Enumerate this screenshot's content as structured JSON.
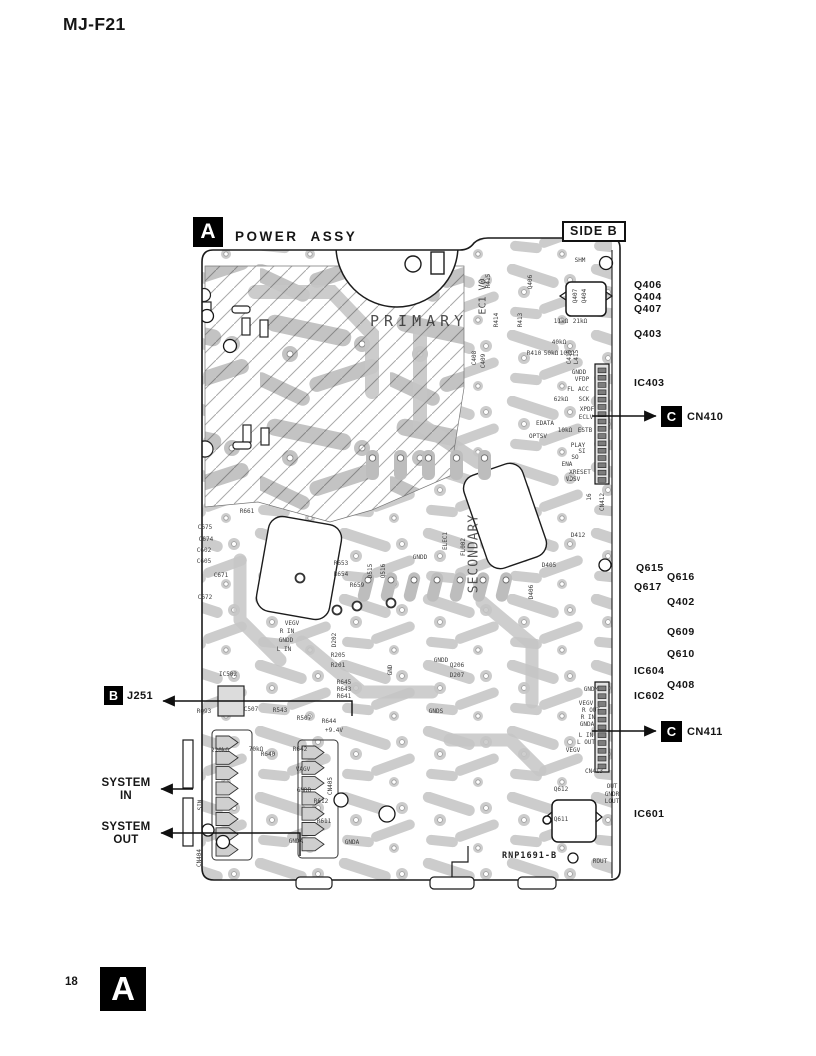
{
  "page": {
    "title": "MJ-F21",
    "page_number": "18",
    "footer_badge": "A"
  },
  "diagram": {
    "badge": "A",
    "badge_b": "B",
    "badge_c": "C",
    "title": "POWER  ASSY",
    "side_label": "SIDE B",
    "board_code": "RNP1691-B",
    "board_text": {
      "primary": "PRIMARY",
      "secondary": "SECONDARY",
      "ec1": "EC1 V0"
    },
    "callouts": {
      "q406": "Q406",
      "q404": "Q404",
      "q407": "Q407",
      "q403": "Q403",
      "ic403": "IC403",
      "cn410": "CN410",
      "q615": "Q615",
      "q616": "Q616",
      "q617": "Q617",
      "q402": "Q402",
      "q609": "Q609",
      "q610": "Q610",
      "ic604": "IC604",
      "q408": "Q408",
      "ic602": "IC602",
      "cn411": "CN411",
      "ic601": "IC601",
      "j251": "J251",
      "system_in_1": "SYSTEM",
      "system_in_2": "IN",
      "system_out_1": "SYSTEM",
      "system_out_2": "OUT"
    },
    "small_labels": [
      {
        "t": "SHM",
        "x": 580,
        "y": 261
      },
      {
        "t": "Q406",
        "x": 531,
        "y": 282,
        "r": -90
      },
      {
        "t": "R415",
        "x": 489,
        "y": 281,
        "r": -90
      },
      {
        "t": "R414",
        "x": 497,
        "y": 320,
        "r": -90
      },
      {
        "t": "R413",
        "x": 521,
        "y": 320,
        "r": -90
      },
      {
        "t": "Q407",
        "x": 576,
        "y": 296,
        "r": -90
      },
      {
        "t": "Q404",
        "x": 585,
        "y": 296,
        "r": -90
      },
      {
        "t": "11kΩ",
        "x": 561,
        "y": 322
      },
      {
        "t": "21kΩ",
        "x": 580,
        "y": 322
      },
      {
        "t": "40kΩ",
        "x": 559,
        "y": 343
      },
      {
        "t": "R410",
        "x": 534,
        "y": 354
      },
      {
        "t": "50kΩ",
        "x": 551,
        "y": 354
      },
      {
        "t": "10kΩ",
        "x": 567,
        "y": 354
      },
      {
        "t": "C415",
        "x": 570,
        "y": 357,
        "r": -90
      },
      {
        "t": "L415",
        "x": 577,
        "y": 357,
        "r": -90
      },
      {
        "t": "C408",
        "x": 475,
        "y": 358,
        "r": -90
      },
      {
        "t": "C409",
        "x": 484,
        "y": 361,
        "r": -90
      },
      {
        "t": "GNDD",
        "x": 579,
        "y": 373
      },
      {
        "t": "VFDP",
        "x": 582,
        "y": 380
      },
      {
        "t": "FL ACC",
        "x": 578,
        "y": 390
      },
      {
        "t": "62kΩ",
        "x": 561,
        "y": 400
      },
      {
        "t": "SCK",
        "x": 584,
        "y": 400
      },
      {
        "t": "XPDF",
        "x": 587,
        "y": 410
      },
      {
        "t": "ECLV",
        "x": 586,
        "y": 418
      },
      {
        "t": "EDATA",
        "x": 545,
        "y": 424
      },
      {
        "t": "10kΩ",
        "x": 565,
        "y": 431
      },
      {
        "t": "ESTB",
        "x": 585,
        "y": 431
      },
      {
        "t": "OPTSV",
        "x": 538,
        "y": 437
      },
      {
        "t": "PLAY",
        "x": 578,
        "y": 446
      },
      {
        "t": "SI",
        "x": 582,
        "y": 452
      },
      {
        "t": "SO",
        "x": 575,
        "y": 458
      },
      {
        "t": "ENA",
        "x": 567,
        "y": 465
      },
      {
        "t": "XRESET",
        "x": 580,
        "y": 473
      },
      {
        "t": "VDSV",
        "x": 573,
        "y": 480
      },
      {
        "t": "16",
        "x": 590,
        "y": 497,
        "r": -90
      },
      {
        "t": "CN412",
        "x": 603,
        "y": 502,
        "r": -90
      },
      {
        "t": "D412",
        "x": 578,
        "y": 536
      },
      {
        "t": "C675",
        "x": 205,
        "y": 528
      },
      {
        "t": "C674",
        "x": 206,
        "y": 540
      },
      {
        "t": "C602",
        "x": 204,
        "y": 551
      },
      {
        "t": "C605",
        "x": 204,
        "y": 562
      },
      {
        "t": "C671",
        "x": 221,
        "y": 576
      },
      {
        "t": "C672",
        "x": 205,
        "y": 598
      },
      {
        "t": "R661",
        "x": 247,
        "y": 512
      },
      {
        "t": "R653",
        "x": 341,
        "y": 564
      },
      {
        "t": "R654",
        "x": 341,
        "y": 575
      },
      {
        "t": "R659",
        "x": 357,
        "y": 586
      },
      {
        "t": "GNDD",
        "x": 420,
        "y": 558
      },
      {
        "t": "ELEC1",
        "x": 446,
        "y": 541,
        "r": -90
      },
      {
        "t": "FL002",
        "x": 464,
        "y": 547,
        "r": -90
      },
      {
        "t": "D515",
        "x": 371,
        "y": 571,
        "r": -90
      },
      {
        "t": "Q516",
        "x": 384,
        "y": 571,
        "r": -90
      },
      {
        "t": "D405",
        "x": 549,
        "y": 566
      },
      {
        "t": "D406",
        "x": 532,
        "y": 592,
        "r": -90
      },
      {
        "t": "D202",
        "x": 335,
        "y": 640,
        "r": -90
      },
      {
        "t": "R205",
        "x": 338,
        "y": 656
      },
      {
        "t": "R201",
        "x": 338,
        "y": 666
      },
      {
        "t": "GND",
        "x": 391,
        "y": 670,
        "r": -90
      },
      {
        "t": "GNDD",
        "x": 441,
        "y": 661
      },
      {
        "t": "Q206",
        "x": 457,
        "y": 666
      },
      {
        "t": "D207",
        "x": 457,
        "y": 676
      },
      {
        "t": "GNDS",
        "x": 436,
        "y": 712
      },
      {
        "t": "VEGV",
        "x": 292,
        "y": 624
      },
      {
        "t": "R IN",
        "x": 287,
        "y": 632
      },
      {
        "t": "GNDD",
        "x": 286,
        "y": 641
      },
      {
        "t": "L IN",
        "x": 284,
        "y": 650
      },
      {
        "t": "IC502",
        "x": 228,
        "y": 675
      },
      {
        "t": "R093",
        "x": 204,
        "y": 712
      },
      {
        "t": "C507",
        "x": 251,
        "y": 710
      },
      {
        "t": "R543",
        "x": 280,
        "y": 711
      },
      {
        "t": "R507",
        "x": 304,
        "y": 719
      },
      {
        "t": "R644",
        "x": 329,
        "y": 722
      },
      {
        "t": "R645",
        "x": 344,
        "y": 683
      },
      {
        "t": "R643",
        "x": 344,
        "y": 690
      },
      {
        "t": "R641",
        "x": 344,
        "y": 697
      },
      {
        "t": "+9.4V",
        "x": 334,
        "y": 731
      },
      {
        "t": "220kΩ",
        "x": 220,
        "y": 751
      },
      {
        "t": "70kΩ",
        "x": 256,
        "y": 750
      },
      {
        "t": "R640",
        "x": 268,
        "y": 755
      },
      {
        "t": "R642",
        "x": 300,
        "y": 750
      },
      {
        "t": "VAGV",
        "x": 303,
        "y": 770
      },
      {
        "t": "GNDD",
        "x": 304,
        "y": 791
      },
      {
        "t": "CN405",
        "x": 331,
        "y": 786,
        "r": -90
      },
      {
        "t": "R612",
        "x": 321,
        "y": 802
      },
      {
        "t": "R611",
        "x": 324,
        "y": 822
      },
      {
        "t": "GNDA",
        "x": 296,
        "y": 842
      },
      {
        "t": "GNDA",
        "x": 352,
        "y": 843
      },
      {
        "t": "SIN",
        "x": 201,
        "y": 805,
        "r": -90
      },
      {
        "t": "CN404",
        "x": 200,
        "y": 858,
        "r": -90
      },
      {
        "t": "GNDM",
        "x": 591,
        "y": 690
      },
      {
        "t": "VEGV",
        "x": 586,
        "y": 704
      },
      {
        "t": "R OUT",
        "x": 591,
        "y": 711
      },
      {
        "t": "R IN",
        "x": 588,
        "y": 718
      },
      {
        "t": "GNDA",
        "x": 587,
        "y": 725
      },
      {
        "t": "L IN",
        "x": 586,
        "y": 736
      },
      {
        "t": "L OUT",
        "x": 586,
        "y": 743
      },
      {
        "t": "VEGV",
        "x": 573,
        "y": 751
      },
      {
        "t": "CN413",
        "x": 594,
        "y": 772
      },
      {
        "t": "OUT",
        "x": 612,
        "y": 787
      },
      {
        "t": "GNDR",
        "x": 612,
        "y": 795
      },
      {
        "t": "LOUT",
        "x": 612,
        "y": 802
      },
      {
        "t": "Q612",
        "x": 561,
        "y": 790
      },
      {
        "t": "Q611",
        "x": 561,
        "y": 820
      },
      {
        "t": "ROUT",
        "x": 600,
        "y": 862
      }
    ]
  },
  "colors": {
    "ink": "#161616",
    "trace_gray": "#c6c6c6",
    "badge_bg": "#000000",
    "badge_fg": "#ffffff"
  }
}
